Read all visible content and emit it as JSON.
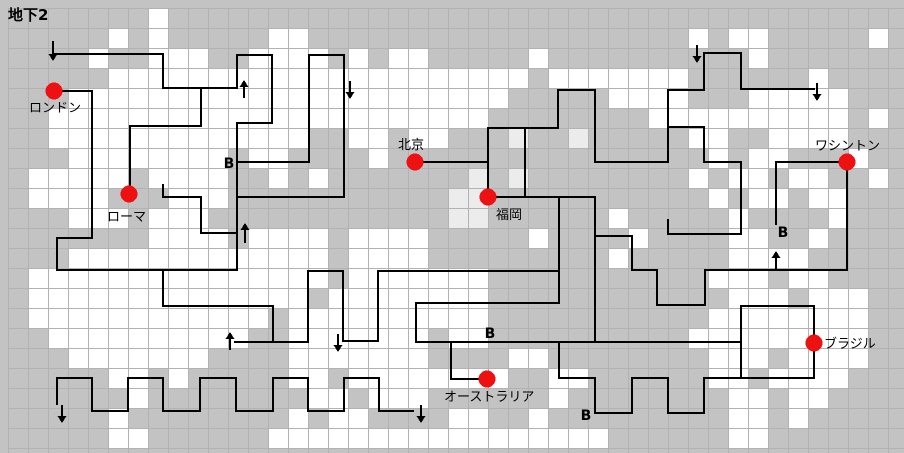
{
  "title": "地下2",
  "colors": {
    "background": "#c3c3c3",
    "grid_line": "#b2b2b2",
    "cell_white": "#ffffff",
    "cell_light": "#ececec",
    "path": "#000000",
    "marker_red": "#ee1111",
    "text": "#000000"
  },
  "grid": {
    "origin": 8,
    "cell": 20,
    "cols": 45,
    "rows": 22,
    "width": 904,
    "height": 453
  },
  "chart_data": {
    "type": "map-grid",
    "white_cell_runs_by_row": [
      [
        [
          7,
          1
        ]
      ],
      [
        [
          5,
          1
        ],
        [
          7,
          1
        ],
        [
          13,
          2
        ],
        [
          34,
          1
        ],
        [
          36,
          2
        ],
        [
          43,
          1
        ]
      ],
      [
        [
          4,
          1
        ],
        [
          7,
          3
        ],
        [
          12,
          4
        ],
        [
          17,
          1
        ],
        [
          19,
          2
        ],
        [
          26,
          1
        ],
        [
          37,
          1
        ]
      ],
      [
        [
          5,
          6
        ],
        [
          11,
          11
        ],
        [
          22,
          4
        ],
        [
          27,
          2
        ],
        [
          29,
          5
        ],
        [
          40,
          1
        ]
      ],
      [
        [
          3,
          8
        ],
        [
          11,
          11
        ],
        [
          22,
          3
        ],
        [
          30,
          4
        ],
        [
          33,
          1
        ],
        [
          37,
          5
        ]
      ],
      [
        [
          2,
          9
        ],
        [
          11,
          11
        ],
        [
          22,
          2
        ],
        [
          32,
          2
        ],
        [
          34,
          8
        ],
        [
          43,
          1
        ]
      ],
      [
        [
          2,
          9
        ],
        [
          11,
          4
        ],
        [
          17,
          2
        ],
        [
          20,
          2
        ],
        [
          34,
          2
        ],
        [
          38,
          4
        ]
      ],
      [
        [
          3,
          8
        ],
        [
          12,
          2
        ],
        [
          18,
          1
        ],
        [
          35,
          1
        ],
        [
          37,
          2
        ],
        [
          42,
          1
        ]
      ],
      [
        [
          1,
          5
        ],
        [
          7,
          4
        ],
        [
          13,
          1
        ],
        [
          15,
          1
        ],
        [
          34,
          1
        ],
        [
          36,
          2
        ],
        [
          39,
          2
        ],
        [
          43,
          1
        ]
      ],
      [
        [
          1,
          4
        ],
        [
          8,
          3
        ],
        [
          35,
          1
        ],
        [
          37,
          2
        ],
        [
          40,
          2
        ]
      ],
      [
        [
          3,
          3
        ],
        [
          7,
          3
        ],
        [
          30,
          1
        ],
        [
          36,
          1
        ],
        [
          41,
          1
        ]
      ],
      [
        [
          7,
          4
        ],
        [
          12,
          4
        ],
        [
          17,
          4
        ],
        [
          26,
          1
        ],
        [
          31,
          1
        ],
        [
          36,
          2
        ],
        [
          40,
          1
        ]
      ],
      [
        [
          3,
          13
        ],
        [
          17,
          4
        ],
        [
          30,
          1
        ],
        [
          36,
          4
        ]
      ],
      [
        [
          1,
          15
        ],
        [
          17,
          5
        ],
        [
          22,
          2
        ],
        [
          35,
          3
        ],
        [
          39,
          2
        ]
      ],
      [
        [
          1,
          14
        ],
        [
          16,
          6
        ],
        [
          22,
          2
        ],
        [
          36,
          3
        ],
        [
          40,
          3
        ]
      ],
      [
        [
          1,
          12
        ],
        [
          14,
          8
        ],
        [
          22,
          2
        ],
        [
          35,
          8
        ]
      ],
      [
        [
          2,
          10
        ],
        [
          14,
          7
        ],
        [
          22,
          2
        ],
        [
          34,
          9
        ]
      ],
      [
        [
          3,
          7
        ],
        [
          14,
          7
        ],
        [
          25,
          2
        ],
        [
          35,
          3
        ],
        [
          39,
          4
        ]
      ],
      [
        [
          5,
          2
        ],
        [
          8,
          1
        ],
        [
          14,
          2
        ],
        [
          17,
          5
        ],
        [
          21,
          4
        ],
        [
          27,
          2
        ],
        [
          35,
          2
        ],
        [
          38,
          4
        ]
      ],
      [
        [
          6,
          1
        ],
        [
          15,
          2
        ],
        [
          18,
          3
        ],
        [
          27,
          1
        ],
        [
          36,
          2
        ],
        [
          39,
          2
        ]
      ],
      [
        [
          5,
          1
        ],
        [
          14,
          1
        ],
        [
          16,
          2
        ],
        [
          22,
          2
        ],
        [
          26,
          1
        ],
        [
          36,
          2
        ],
        [
          39,
          1
        ]
      ],
      [
        [
          5,
          2
        ],
        [
          13,
          17
        ],
        [
          36,
          2
        ]
      ]
    ],
    "light_cell_runs_by_row": {
      "6": [
        [
          25,
          1
        ],
        [
          28,
          1
        ]
      ],
      "8": [
        [
          23,
          1
        ],
        [
          25,
          1
        ]
      ],
      "9": [
        [
          22,
          2
        ]
      ],
      "10": [
        [
          22,
          2
        ]
      ]
    },
    "path_segments": [
      [
        55,
        54,
        163,
        54
      ],
      [
        163,
        54,
        163,
        88
      ],
      [
        163,
        88,
        237,
        88
      ],
      [
        54,
        91,
        92,
        91
      ],
      [
        92,
        91,
        92,
        238
      ],
      [
        57,
        238,
        92,
        238
      ],
      [
        57,
        238,
        57,
        270
      ],
      [
        57,
        270,
        237,
        270
      ],
      [
        237,
        55,
        272,
        55
      ],
      [
        272,
        55,
        272,
        123
      ],
      [
        237,
        123,
        272,
        123
      ],
      [
        237,
        55,
        237,
        88
      ],
      [
        237,
        123,
        237,
        270
      ],
      [
        237,
        162,
        309,
        162
      ],
      [
        309,
        55,
        344,
        55
      ],
      [
        309,
        55,
        309,
        162
      ],
      [
        344,
        55,
        344,
        197
      ],
      [
        237,
        197,
        344,
        197
      ],
      [
        201,
        88,
        201,
        126
      ],
      [
        130,
        126,
        201,
        126
      ],
      [
        130,
        126,
        130,
        193
      ],
      [
        163,
        185,
        163,
        197
      ],
      [
        163,
        197,
        201,
        197
      ],
      [
        201,
        197,
        201,
        233
      ],
      [
        201,
        233,
        237,
        233
      ],
      [
        415,
        162,
        488,
        162
      ],
      [
        488,
        128,
        488,
        197
      ],
      [
        488,
        128,
        558,
        128
      ],
      [
        525,
        128,
        525,
        197
      ],
      [
        487,
        197,
        595,
        197
      ],
      [
        558,
        90,
        558,
        128
      ],
      [
        558,
        90,
        595,
        90
      ],
      [
        595,
        90,
        595,
        162
      ],
      [
        595,
        162,
        668,
        162
      ],
      [
        668,
        90,
        668,
        162
      ],
      [
        668,
        90,
        704,
        90
      ],
      [
        668,
        127,
        704,
        127
      ],
      [
        704,
        127,
        704,
        162
      ],
      [
        704,
        162,
        741,
        162
      ],
      [
        741,
        162,
        741,
        234
      ],
      [
        668,
        220,
        668,
        234
      ],
      [
        668,
        234,
        741,
        234
      ],
      [
        704,
        53,
        704,
        90
      ],
      [
        704,
        53,
        741,
        53
      ],
      [
        741,
        53,
        741,
        89
      ],
      [
        741,
        89,
        814,
        89
      ],
      [
        776,
        162,
        847,
        162
      ],
      [
        776,
        162,
        776,
        224
      ],
      [
        847,
        162,
        847,
        270
      ],
      [
        705,
        270,
        847,
        270
      ],
      [
        705,
        270,
        705,
        305
      ],
      [
        657,
        305,
        705,
        305
      ],
      [
        657,
        270,
        657,
        305
      ],
      [
        632,
        270,
        657,
        270
      ],
      [
        632,
        236,
        632,
        270
      ],
      [
        595,
        236,
        632,
        236
      ],
      [
        595,
        197,
        595,
        341
      ],
      [
        559,
        197,
        559,
        303
      ],
      [
        416,
        303,
        559,
        303
      ],
      [
        416,
        303,
        416,
        342
      ],
      [
        416,
        342,
        741,
        342
      ],
      [
        378,
        271,
        559,
        271
      ],
      [
        378,
        271,
        378,
        341
      ],
      [
        343,
        341,
        378,
        341
      ],
      [
        308,
        271,
        343,
        271
      ],
      [
        308,
        271,
        308,
        342
      ],
      [
        343,
        271,
        343,
        341
      ],
      [
        235,
        342,
        308,
        342
      ],
      [
        273,
        306,
        273,
        342
      ],
      [
        163,
        306,
        273,
        306
      ],
      [
        163,
        270,
        163,
        306
      ],
      [
        451,
        342,
        451,
        379
      ],
      [
        451,
        379,
        487,
        379
      ],
      [
        559,
        342,
        559,
        378
      ],
      [
        559,
        378,
        595,
        378
      ],
      [
        595,
        378,
        595,
        413
      ],
      [
        595,
        413,
        632,
        413
      ],
      [
        632,
        378,
        632,
        413
      ],
      [
        632,
        378,
        668,
        378
      ],
      [
        668,
        378,
        668,
        413
      ],
      [
        668,
        413,
        704,
        413
      ],
      [
        704,
        378,
        704,
        413
      ],
      [
        704,
        378,
        741,
        378
      ],
      [
        741,
        306,
        741,
        378
      ],
      [
        741,
        306,
        814,
        306
      ],
      [
        814,
        306,
        814,
        378
      ],
      [
        741,
        378,
        814,
        378
      ],
      [
        57,
        378,
        57,
        404
      ],
      [
        57,
        378,
        92,
        378
      ],
      [
        92,
        378,
        92,
        411
      ],
      [
        92,
        411,
        128,
        411
      ],
      [
        128,
        378,
        128,
        411
      ],
      [
        128,
        378,
        163,
        378
      ],
      [
        163,
        378,
        163,
        411
      ],
      [
        163,
        411,
        200,
        411
      ],
      [
        200,
        378,
        200,
        411
      ],
      [
        200,
        378,
        236,
        378
      ],
      [
        236,
        378,
        236,
        411
      ],
      [
        236,
        411,
        273,
        411
      ],
      [
        273,
        378,
        273,
        411
      ],
      [
        273,
        378,
        308,
        378
      ],
      [
        308,
        378,
        308,
        411
      ],
      [
        308,
        411,
        344,
        411
      ],
      [
        344,
        378,
        344,
        411
      ],
      [
        344,
        378,
        379,
        378
      ],
      [
        379,
        378,
        379,
        411
      ],
      [
        379,
        411,
        413,
        411
      ]
    ],
    "arrows": [
      {
        "x": 53,
        "from": 41,
        "to": 61
      },
      {
        "x": 244,
        "from": 98,
        "to": 80
      },
      {
        "x": 350,
        "from": 81,
        "to": 99
      },
      {
        "x": 697,
        "from": 45,
        "to": 63
      },
      {
        "x": 817,
        "from": 83,
        "to": 101
      },
      {
        "x": 245,
        "from": 243,
        "to": 223
      },
      {
        "x": 230,
        "from": 350,
        "to": 332
      },
      {
        "x": 338,
        "from": 334,
        "to": 352
      },
      {
        "x": 776,
        "from": 269,
        "to": 251
      },
      {
        "x": 62,
        "from": 405,
        "to": 423
      },
      {
        "x": 421,
        "from": 405,
        "to": 423
      }
    ]
  },
  "markers": [
    {
      "id": "london",
      "label": "ロンドン",
      "x": 54,
      "y": 91,
      "lx": 29,
      "ly": 112
    },
    {
      "id": "rome",
      "label": "ローマ",
      "x": 129,
      "y": 194,
      "lx": 107,
      "ly": 221
    },
    {
      "id": "beijing",
      "label": "北京",
      "x": 415,
      "y": 162,
      "lx": 398,
      "ly": 149
    },
    {
      "id": "fukuoka",
      "label": "福岡",
      "x": 488,
      "y": 197,
      "lx": 496,
      "ly": 219
    },
    {
      "id": "washington",
      "label": "ワシントン",
      "x": 847,
      "y": 162,
      "lx": 815,
      "ly": 150
    },
    {
      "id": "brazil",
      "label": "ブラジル",
      "x": 814,
      "y": 343,
      "lx": 824,
      "ly": 348
    },
    {
      "id": "australia",
      "label": "オーストラリア",
      "x": 487,
      "y": 379,
      "lx": 444,
      "ly": 401
    }
  ],
  "b_marks": [
    {
      "label": "B",
      "x": 229,
      "y": 168
    },
    {
      "label": "B",
      "x": 490,
      "y": 338
    },
    {
      "label": "B",
      "x": 586,
      "y": 420
    },
    {
      "label": "B",
      "x": 783,
      "y": 237
    }
  ]
}
